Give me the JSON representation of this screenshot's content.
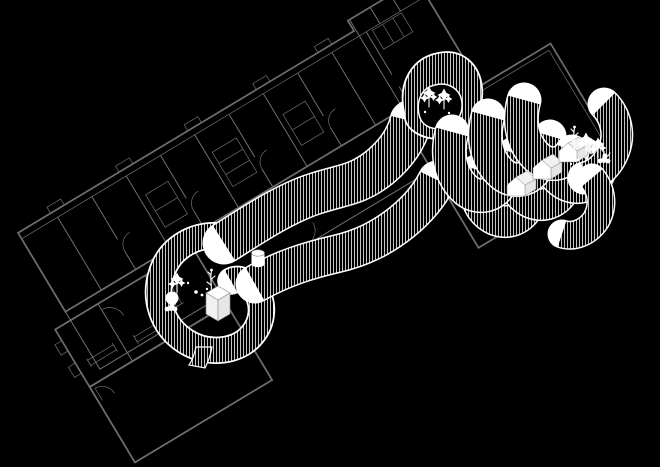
{
  "canvas": {
    "width": 660,
    "height": 467,
    "background": "#000000"
  },
  "palette": {
    "plan_line": "#6f6f6f",
    "ribbon_edge": "#ffffff",
    "hatch_stripe": "#c4c4c4",
    "object_white": "#ffffff",
    "object_shade": "#e6e6e6",
    "object_outline": "#8a8a8a"
  },
  "scene": {
    "kind": "architectural-axonometric-drawing",
    "layers": [
      {
        "name": "existing-building-plan",
        "style": "thin gray linework, L-shaped building with rooms, door swings, radiators, furniture"
      },
      {
        "name": "ribbon-wall",
        "style": "serpentine wall faces, black with fine vertical white hatching and white edges"
      },
      {
        "name": "white-objects",
        "style": "white silhouettes of trees, shrubs, huts, cube, cylinder and scatter dots inside the pockets"
      }
    ],
    "pockets": [
      "spiral-pocket-lower-left",
      "tree-pocket-top",
      "scallop-pockets-right"
    ],
    "object_counts": {
      "huts": 3,
      "tree_clusters": 4,
      "cubes": 2,
      "cylinders": 1
    }
  }
}
